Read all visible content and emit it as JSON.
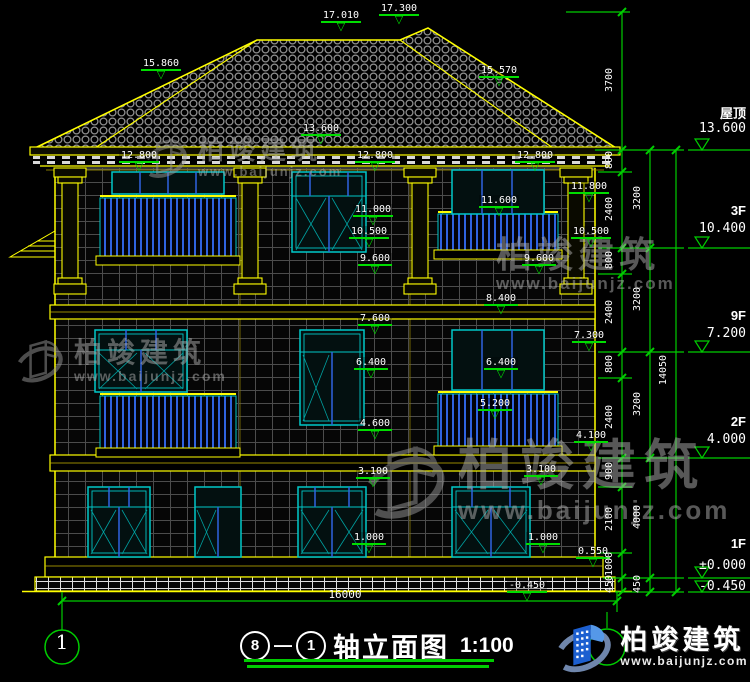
{
  "brand": {
    "name": "柏竣建筑",
    "site": "www.baijunjz.com"
  },
  "title": {
    "axis_a": "8",
    "dash": "—",
    "axis_b": "1",
    "text": "轴立面图",
    "scale": "1:100"
  },
  "bottom": {
    "overall_dim": "16000",
    "axis_bubble_left": "1"
  },
  "colors": {
    "line_green": "#00dd00",
    "line_yellow": "#ffff00",
    "window_cyan": "#00c8c8",
    "rail_blue": "#2f62e0",
    "text_white": "#ffffff",
    "watermark_gray": "#b0b0b0",
    "logo_blue": "#1c5fd0",
    "background": "#000000"
  },
  "markers": [
    {
      "v": "17.010",
      "x": 318,
      "y": 10
    },
    {
      "v": "17.300",
      "x": 376,
      "y": 3
    },
    {
      "v": "15.860",
      "x": 138,
      "y": 58
    },
    {
      "v": "15.570",
      "x": 476,
      "y": 65
    },
    {
      "v": "13.600",
      "x": 298,
      "y": 123
    },
    {
      "v": "12.800",
      "x": 116,
      "y": 150
    },
    {
      "v": "12.800",
      "x": 352,
      "y": 150
    },
    {
      "v": "12.800",
      "x": 512,
      "y": 150
    },
    {
      "v": "11.800",
      "x": 566,
      "y": 181
    },
    {
      "v": "11.600",
      "x": 476,
      "y": 195
    },
    {
      "v": "11.000",
      "x": 350,
      "y": 204
    },
    {
      "v": "10.500",
      "x": 346,
      "y": 226
    },
    {
      "v": "10.500",
      "x": 568,
      "y": 226
    },
    {
      "v": "9.600",
      "x": 352,
      "y": 253
    },
    {
      "v": "9.600",
      "x": 516,
      "y": 253
    },
    {
      "v": "8.400",
      "x": 478,
      "y": 293
    },
    {
      "v": "7.600",
      "x": 352,
      "y": 313
    },
    {
      "v": "7.300",
      "x": 566,
      "y": 330
    },
    {
      "v": "6.400",
      "x": 348,
      "y": 357
    },
    {
      "v": "6.400",
      "x": 478,
      "y": 357
    },
    {
      "v": "5.200",
      "x": 472,
      "y": 398
    },
    {
      "v": "4.600",
      "x": 352,
      "y": 418
    },
    {
      "v": "4.100",
      "x": 568,
      "y": 430
    },
    {
      "v": "3.100",
      "x": 350,
      "y": 466
    },
    {
      "v": "3.100",
      "x": 518,
      "y": 464
    },
    {
      "v": "1.000",
      "x": 346,
      "y": 532
    },
    {
      "v": "1.000",
      "x": 520,
      "y": 532
    },
    {
      "v": "0.550",
      "x": 570,
      "y": 546
    },
    {
      "v": "-0.450",
      "x": 504,
      "y": 580
    }
  ],
  "floors": [
    {
      "label": "屋顶",
      "elev": "13.600",
      "name_y": 103,
      "elev_y": 121
    },
    {
      "label": "3F",
      "elev": "10.400",
      "name_y": 203,
      "elev_y": 221
    },
    {
      "label": "9F",
      "elev": "7.200",
      "name_y": 308,
      "elev_y": 326
    },
    {
      "label": "2F",
      "elev": "4.000",
      "name_y": 414,
      "elev_y": 432
    },
    {
      "label": "1F",
      "elev": "±0.000",
      "name_y": 536,
      "elev_y": 558
    },
    {
      "label": "",
      "elev": "-0.450",
      "name_y": 0,
      "elev_y": 579
    }
  ],
  "dims_inner": [
    {
      "v": "3700",
      "y": 81
    },
    {
      "v": "800",
      "y": 161
    },
    {
      "v": "2400",
      "y": 210
    },
    {
      "v": "800",
      "y": 261
    },
    {
      "v": "2400",
      "y": 313
    },
    {
      "v": "800",
      "y": 365
    },
    {
      "v": "2400",
      "y": 418
    },
    {
      "v": "900",
      "y": 472
    },
    {
      "v": "2100",
      "y": 520
    },
    {
      "v": "1000",
      "y": 565
    },
    {
      "v": "450",
      "y": 585
    }
  ],
  "dims_middle": [
    {
      "v": "3200",
      "y": 199
    },
    {
      "v": "3200",
      "y": 300
    },
    {
      "v": "3200",
      "y": 405
    },
    {
      "v": "4000",
      "y": 518
    },
    {
      "v": "450",
      "y": 585
    }
  ],
  "dims_outer": [
    {
      "v": "14050",
      "y": 371
    }
  ]
}
